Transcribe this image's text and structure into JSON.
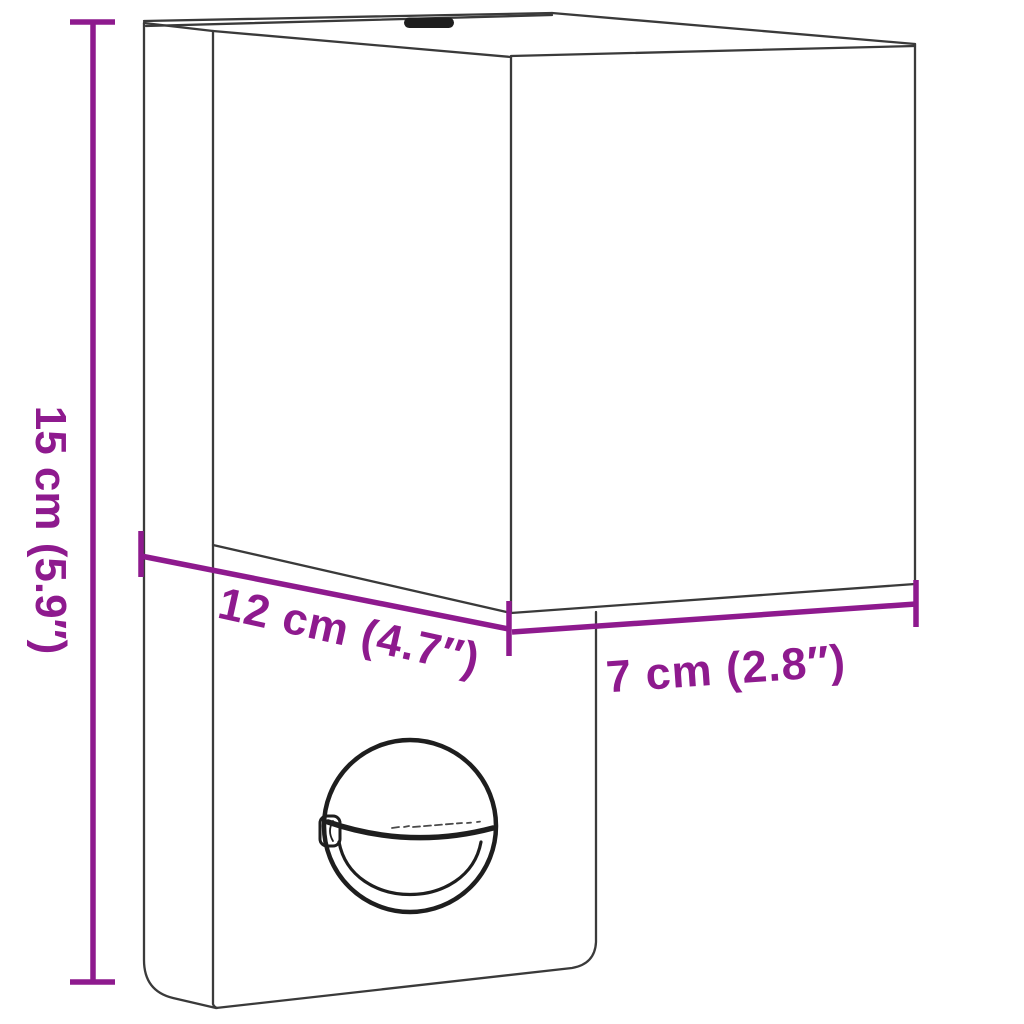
{
  "diagram": {
    "subject": "line drawing of a wall-mounted outdoor light with motion sensor",
    "background": "#FFFFFF"
  },
  "dimensions": {
    "height": {
      "label": "15 cm (5.9″)"
    },
    "depth": {
      "label": "12 cm (4.7″)"
    },
    "width": {
      "label": "7 cm (2.8″)"
    }
  },
  "colors": {
    "accent": "#8E1A8E",
    "outline": "#3A3A3A",
    "sensor": "#1E1E1E"
  }
}
